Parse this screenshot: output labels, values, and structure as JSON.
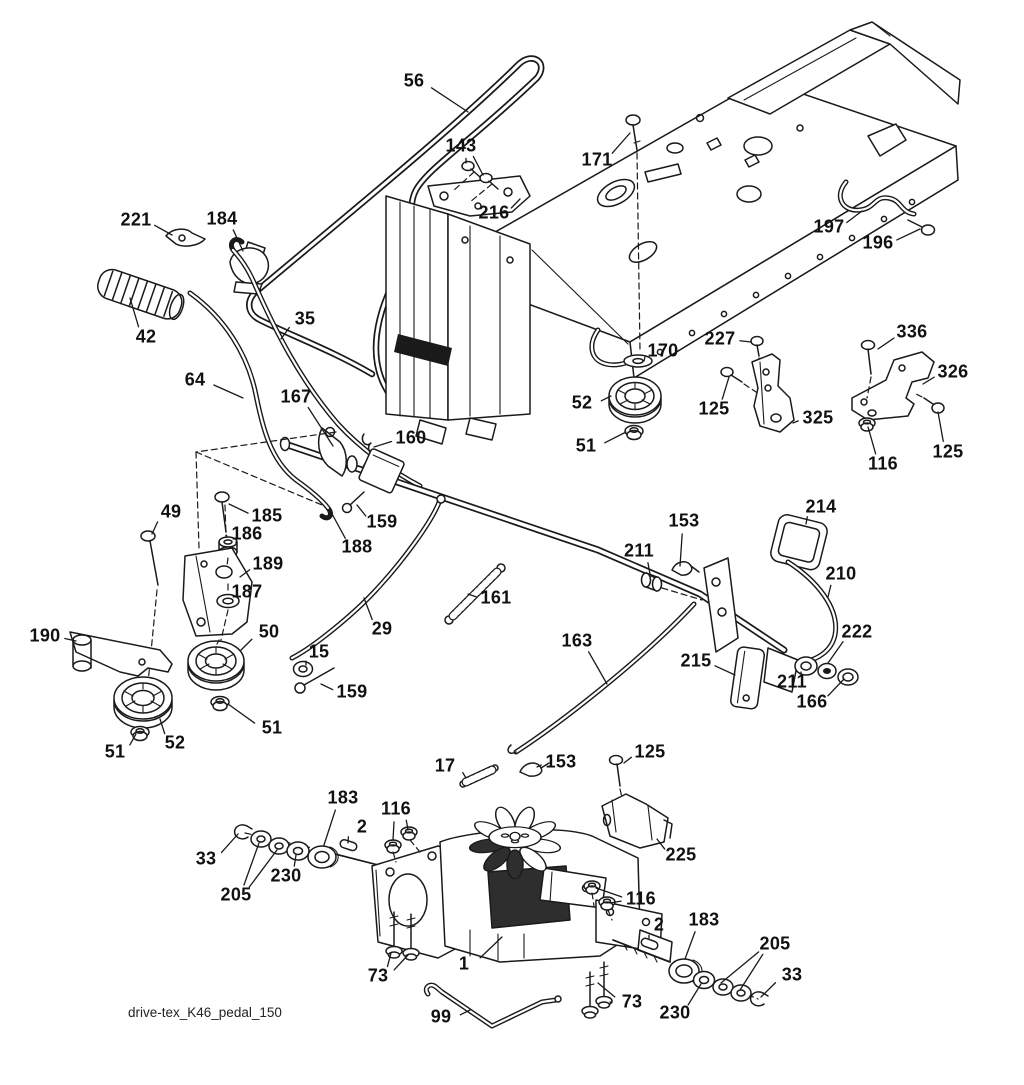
{
  "diagram": {
    "footer": "drive-tex_K46_pedal_150",
    "background": "#ffffff",
    "line_color": "#1a1a1a",
    "labels": [
      {
        "t": "56",
        "x": 414,
        "y": 82,
        "l": [
          [
            468,
            112
          ]
        ]
      },
      {
        "t": "143",
        "x": 461,
        "y": 147,
        "l": [
          [
            466,
            163
          ],
          [
            483,
            175
          ]
        ]
      },
      {
        "t": "171",
        "x": 597,
        "y": 161,
        "l": [
          [
            630,
            133
          ]
        ]
      },
      {
        "t": "216",
        "x": 494,
        "y": 214,
        "l": [
          [
            520,
            199
          ]
        ]
      },
      {
        "t": "221",
        "x": 136,
        "y": 221,
        "l": [
          [
            172,
            235
          ]
        ]
      },
      {
        "t": "184",
        "x": 222,
        "y": 220,
        "l": [
          [
            243,
            251
          ]
        ]
      },
      {
        "t": "42",
        "x": 146,
        "y": 338,
        "l": [
          [
            130,
            298
          ]
        ]
      },
      {
        "t": "35",
        "x": 305,
        "y": 320,
        "l": [
          [
            281,
            339
          ]
        ]
      },
      {
        "t": "64",
        "x": 195,
        "y": 381,
        "l": [
          [
            243,
            398
          ]
        ]
      },
      {
        "t": "167",
        "x": 296,
        "y": 398,
        "l": [
          [
            333,
            446
          ]
        ]
      },
      {
        "t": "160",
        "x": 411,
        "y": 439,
        "l": [
          [
            374,
            447
          ]
        ]
      },
      {
        "t": "170",
        "x": 663,
        "y": 352,
        "l": [
          [
            644,
            361
          ]
        ]
      },
      {
        "t": "52",
        "x": 582,
        "y": 404,
        "l": [
          [
            611,
            396
          ]
        ]
      },
      {
        "t": "51",
        "x": 586,
        "y": 447,
        "l": [
          [
            626,
            432
          ]
        ]
      },
      {
        "t": "227",
        "x": 720,
        "y": 340,
        "l": [
          [
            751,
            342
          ]
        ]
      },
      {
        "t": "125",
        "x": 714,
        "y": 410,
        "l": [
          [
            729,
            377
          ]
        ]
      },
      {
        "t": "325",
        "x": 818,
        "y": 419,
        "l": [
          [
            793,
            423
          ]
        ]
      },
      {
        "t": "336",
        "x": 912,
        "y": 333,
        "l": [
          [
            878,
            349
          ]
        ]
      },
      {
        "t": "326",
        "x": 953,
        "y": 373,
        "l": [
          [
            923,
            384
          ]
        ]
      },
      {
        "t": "116",
        "x": 883,
        "y": 465,
        "l": [
          [
            868,
            427
          ]
        ]
      },
      {
        "t": "125",
        "x": 948,
        "y": 453,
        "l": [
          [
            938,
            412
          ]
        ]
      },
      {
        "t": "197",
        "x": 829,
        "y": 228,
        "l": [
          [
            862,
            211
          ]
        ]
      },
      {
        "t": "196",
        "x": 878,
        "y": 244,
        "l": [
          [
            920,
            229
          ]
        ]
      },
      {
        "t": "49",
        "x": 171,
        "y": 513,
        "l": [
          [
            152,
            534
          ]
        ]
      },
      {
        "t": "185",
        "x": 267,
        "y": 517,
        "l": [
          [
            229,
            504
          ]
        ]
      },
      {
        "t": "186",
        "x": 247,
        "y": 535,
        "l": [
          [
            236,
            543
          ]
        ]
      },
      {
        "t": "189",
        "x": 268,
        "y": 565,
        "l": [
          [
            240,
            577
          ]
        ]
      },
      {
        "t": "187",
        "x": 247,
        "y": 593,
        "l": [
          [
            239,
            600
          ]
        ]
      },
      {
        "t": "188",
        "x": 357,
        "y": 548,
        "l": [
          [
            331,
            512
          ]
        ]
      },
      {
        "t": "159",
        "x": 382,
        "y": 523,
        "l": [
          [
            357,
            505
          ]
        ]
      },
      {
        "t": "161",
        "x": 496,
        "y": 599,
        "l": [
          [
            468,
            594
          ]
        ]
      },
      {
        "t": "29",
        "x": 382,
        "y": 630,
        "l": [
          [
            364,
            598
          ]
        ]
      },
      {
        "t": "190",
        "x": 45,
        "y": 637,
        "l": [
          [
            76,
            641
          ]
        ]
      },
      {
        "t": "50",
        "x": 269,
        "y": 633,
        "l": [
          [
            241,
            650
          ]
        ]
      },
      {
        "t": "15",
        "x": 319,
        "y": 653,
        "l": [
          [
            306,
            665
          ]
        ]
      },
      {
        "t": "159",
        "x": 352,
        "y": 693,
        "l": [
          [
            321,
            684
          ]
        ]
      },
      {
        "t": "51",
        "x": 115,
        "y": 753,
        "l": [
          [
            136,
            734
          ]
        ]
      },
      {
        "t": "52",
        "x": 175,
        "y": 744,
        "l": [
          [
            160,
            719
          ]
        ]
      },
      {
        "t": "51",
        "x": 272,
        "y": 729,
        "l": [
          [
            228,
            704
          ]
        ]
      },
      {
        "t": "214",
        "x": 821,
        "y": 508,
        "l": [
          [
            806,
            524
          ]
        ]
      },
      {
        "t": "153",
        "x": 684,
        "y": 522,
        "l": [
          [
            680,
            566
          ]
        ]
      },
      {
        "t": "211",
        "x": 639,
        "y": 552,
        "l": [
          [
            650,
            574
          ]
        ]
      },
      {
        "t": "210",
        "x": 841,
        "y": 575,
        "l": [
          [
            828,
            597
          ]
        ]
      },
      {
        "t": "222",
        "x": 857,
        "y": 633,
        "l": [
          [
            828,
            663
          ]
        ]
      },
      {
        "t": "215",
        "x": 696,
        "y": 662,
        "l": [
          [
            735,
            675
          ]
        ]
      },
      {
        "t": "211",
        "x": 792,
        "y": 683,
        "l": [
          [
            801,
            672
          ]
        ]
      },
      {
        "t": "166",
        "x": 812,
        "y": 703,
        "l": [
          [
            844,
            679
          ]
        ]
      },
      {
        "t": "163",
        "x": 577,
        "y": 642,
        "l": [
          [
            607,
            684
          ]
        ]
      },
      {
        "t": "17",
        "x": 445,
        "y": 767,
        "l": [
          [
            466,
            778
          ]
        ]
      },
      {
        "t": "153",
        "x": 561,
        "y": 763,
        "l": [
          [
            537,
            767
          ]
        ]
      },
      {
        "t": "125",
        "x": 650,
        "y": 753,
        "l": [
          [
            624,
            763
          ]
        ]
      },
      {
        "t": "225",
        "x": 681,
        "y": 856,
        "l": [
          [
            657,
            839
          ]
        ]
      },
      {
        "t": "183",
        "x": 343,
        "y": 799,
        "l": [
          [
            324,
            845
          ]
        ]
      },
      {
        "t": "116",
        "x": 396,
        "y": 810,
        "l": [
          [
            393,
            840
          ],
          [
            408,
            830
          ]
        ]
      },
      {
        "t": "2",
        "x": 362,
        "y": 828,
        "l": [
          [
            348,
            843
          ]
        ]
      },
      {
        "t": "33",
        "x": 206,
        "y": 860,
        "l": [
          [
            238,
            834
          ]
        ]
      },
      {
        "t": "205",
        "x": 236,
        "y": 896,
        "l": [
          [
            259,
            843
          ],
          [
            277,
            850
          ]
        ]
      },
      {
        "t": "230",
        "x": 286,
        "y": 877,
        "l": [
          [
            296,
            855
          ]
        ]
      },
      {
        "t": "73",
        "x": 378,
        "y": 977,
        "l": [
          [
            391,
            953
          ],
          [
            408,
            955
          ]
        ]
      },
      {
        "t": "1",
        "x": 464,
        "y": 965,
        "l": [
          [
            502,
            937
          ]
        ]
      },
      {
        "t": "99",
        "x": 441,
        "y": 1018,
        "l": [
          [
            470,
            1010
          ]
        ]
      },
      {
        "t": "116",
        "x": 641,
        "y": 900,
        "l": [
          [
            596,
            888
          ],
          [
            610,
            903
          ]
        ]
      },
      {
        "t": "2",
        "x": 659,
        "y": 926,
        "l": [
          [
            649,
            938
          ]
        ]
      },
      {
        "t": "183",
        "x": 704,
        "y": 921,
        "l": [
          [
            685,
            959
          ]
        ]
      },
      {
        "t": "205",
        "x": 775,
        "y": 945,
        "l": [
          [
            721,
            983
          ],
          [
            740,
            990
          ]
        ]
      },
      {
        "t": "33",
        "x": 792,
        "y": 976,
        "l": [
          [
            761,
            997
          ]
        ]
      },
      {
        "t": "230",
        "x": 675,
        "y": 1014,
        "l": [
          [
            701,
            984
          ]
        ]
      },
      {
        "t": "73",
        "x": 632,
        "y": 1003,
        "l": [
          [
            610,
            1002
          ],
          [
            598,
            983
          ]
        ]
      }
    ]
  }
}
